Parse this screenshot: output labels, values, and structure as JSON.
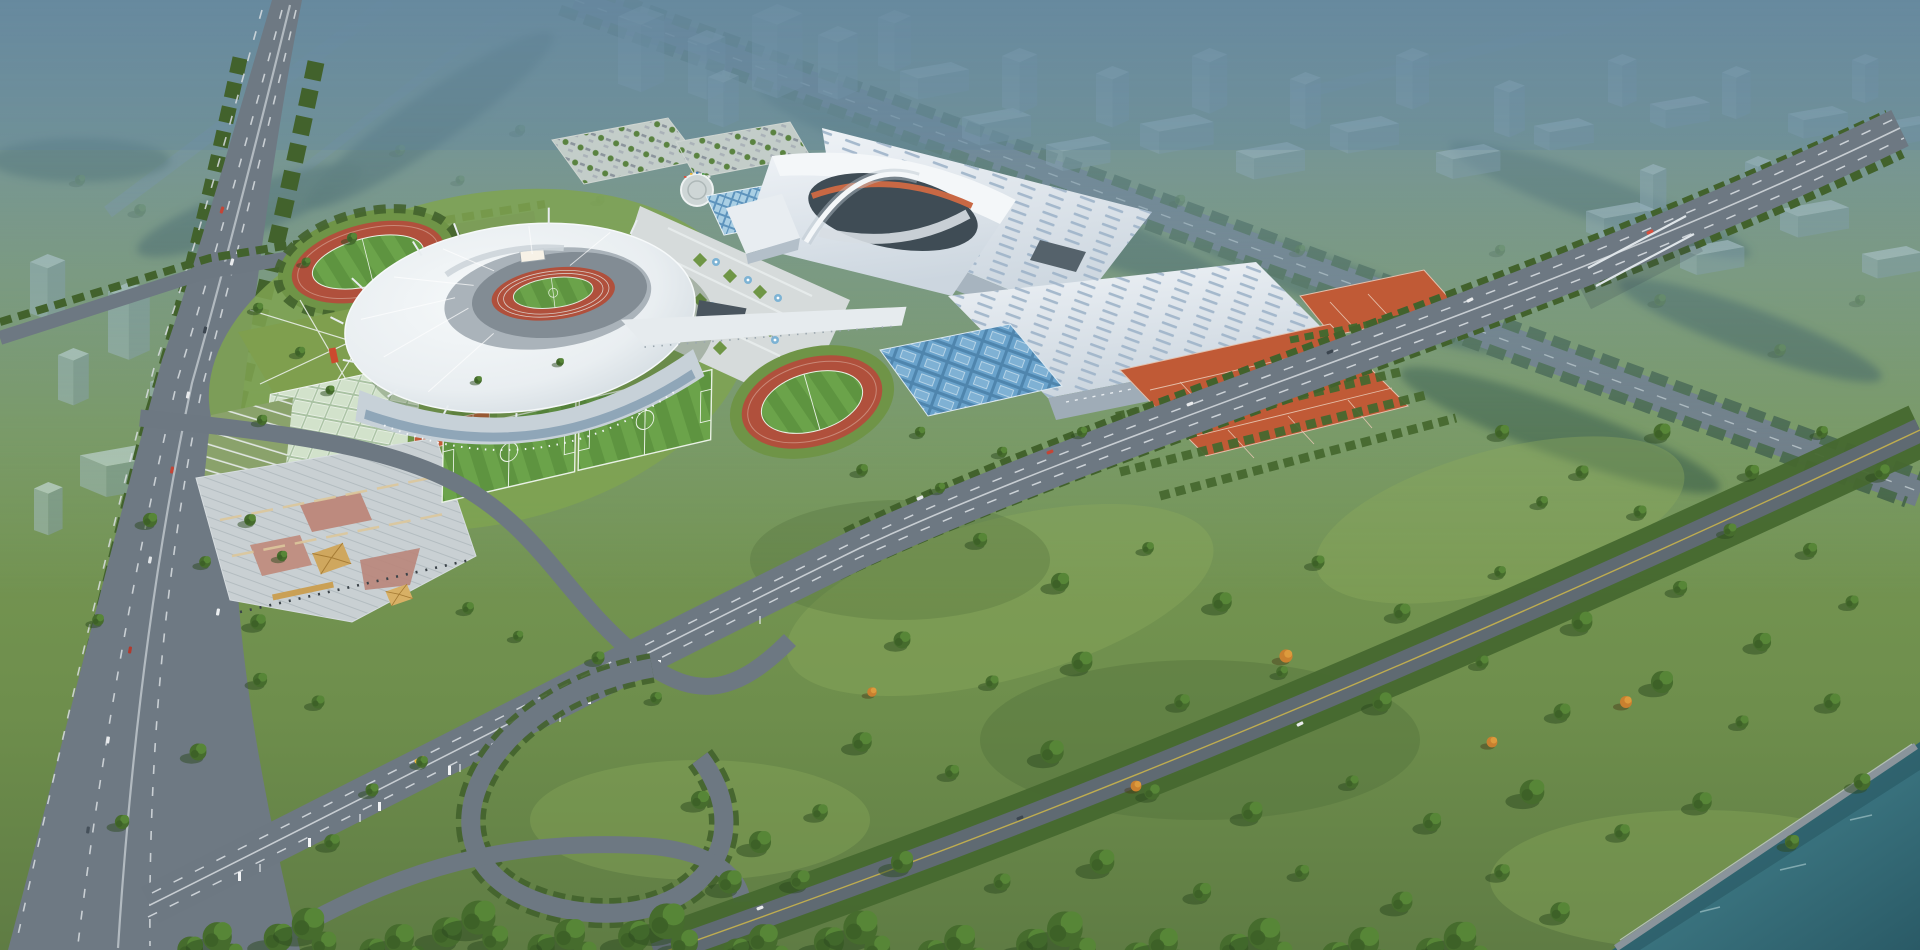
{
  "scene": {
    "type": "aerial-architectural-rendering",
    "subject": "Bird's-eye rendering of a large sports-center masterplan: saddle-roof main stadium with red running track, arched gymnasium and white exhibition halls, fountain plaza, training tracks, soccer pitches, clay and hard tennis courts, basketball court grid, terraced garden plaza with golden pavilions, urban highway and loop ramp, hazy high-rise city in background, wooded riverside park and teal river",
    "atmosphere": "hazy blue daylight, crisp sunlit foreground",
    "visible_text": ""
  },
  "colors": {
    "fog": "#6d8fa0",
    "ghost_building": "#b9cdd6",
    "grass": "#789955",
    "grass_dark": "#55743e",
    "tree": "#466c2d",
    "tree_dark": "#2c4a20",
    "autumn": "#cc8632",
    "road": "#6d7882",
    "road_dark": "#5f6a72",
    "highway": "#6e7983",
    "lane": "#d9dee2",
    "roof_white": "#eef1f3",
    "seating": "#828c94",
    "track_red": "#b0503c",
    "pitch_green": "#5e9440",
    "pitch_stripe": "#6ba34a",
    "hall_roof": "#e2e8ee",
    "hall_side": "#a7b4bf",
    "skylight": "#9fb4c9",
    "arena_dark": "#3f4c55",
    "arena_orange": "#c86844",
    "clay": "#c05a36",
    "court_blue": "#6aa3cc",
    "pool_blue": "#7db3d4",
    "pavement": "#d6dbdb",
    "terrace": "#c9d0d3",
    "pink_path": "#bd8a7e",
    "gold": "#cfa75e",
    "river": "#3f7f88",
    "shore": "#8a949b",
    "glass": "#8fa6b8",
    "screen": "#f7f2e7"
  },
  "landmarks": [
    {
      "id": "main-stadium",
      "label": "Main stadium"
    },
    {
      "id": "arena",
      "label": "Gymnasium with arch"
    },
    {
      "id": "exhibition-hall-north",
      "label": "Exhibition hall (north)"
    },
    {
      "id": "exhibition-hall-south",
      "label": "Exhibition hall (south)"
    },
    {
      "id": "fountain-plaza",
      "label": "Fountain plaza"
    },
    {
      "id": "training-track-northwest",
      "label": "Training track NW"
    },
    {
      "id": "training-track-east",
      "label": "Training track E"
    },
    {
      "id": "soccer-fields",
      "label": "Soccer pitches"
    },
    {
      "id": "clay-courts",
      "label": "Clay tennis courts"
    },
    {
      "id": "blue-courts",
      "label": "Hard courts"
    },
    {
      "id": "basketball-courts",
      "label": "Basketball court grid"
    },
    {
      "id": "terraced-plaza",
      "label": "Terraced garden plaza"
    },
    {
      "id": "left-highway",
      "label": "Urban expressway"
    },
    {
      "id": "loop-ramp",
      "label": "Loop ramp"
    },
    {
      "id": "boulevard",
      "label": "Front boulevard"
    },
    {
      "id": "park-avenue",
      "label": "Park avenue"
    },
    {
      "id": "river",
      "label": "River"
    },
    {
      "id": "ghost-city",
      "label": "Hazy planned city"
    }
  ]
}
